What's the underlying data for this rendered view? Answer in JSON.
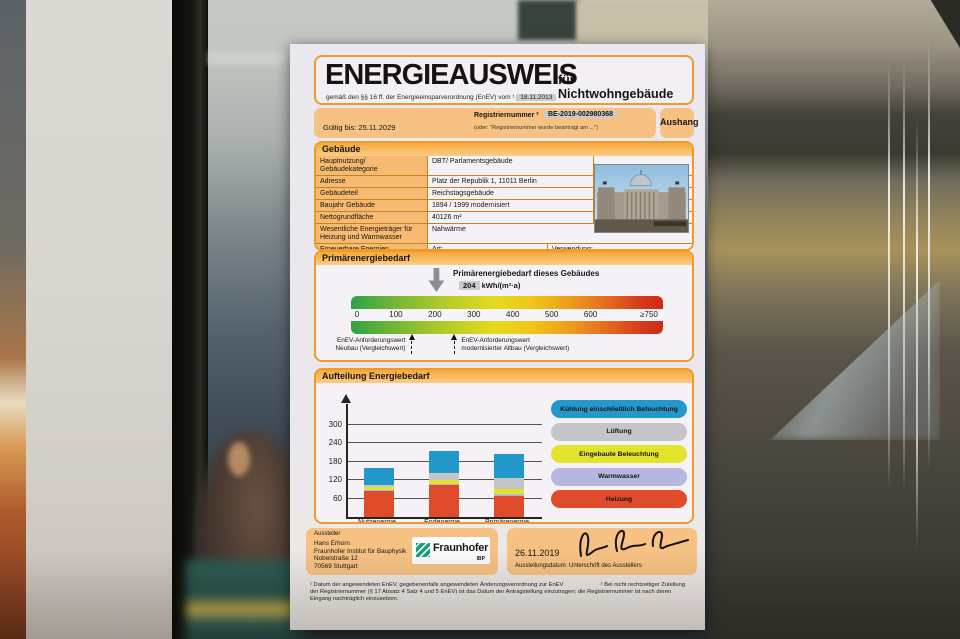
{
  "certificate": {
    "title": "ENERGIEAUSWEIS",
    "title_suffix": "für Nichtwohngebäude",
    "subtitle": "gemäß den §§ 16 ff. der Energieeinsparverordnung (EnEV) vom ¹",
    "subtitle_date": "18.11.2013",
    "valid_until": "Gültig bis: 25.11.2029",
    "registry_label": "Registriernummer ²",
    "registry_number": "BE-2019-002980368",
    "registry_note": "(oder: \"Registriernummer wurde beantragt am ...\")",
    "display_type": "Aushang"
  },
  "building": {
    "header": "Gebäude",
    "rows": [
      {
        "label": "Hauptnutzung/ Gebäudekategorie",
        "value": "DBT/ Parlamentsgebäude",
        "short": true
      },
      {
        "label": "Adresse",
        "value": "Platz der Republik 1, 11011 Berlin",
        "short": true
      },
      {
        "label": "Gebäudeteil",
        "value": "Reichstagsgebäude",
        "short": true
      },
      {
        "label": "Baujahr Gebäude",
        "value": "1894 / 1999 modernisiert",
        "short": true
      },
      {
        "label": "Nettogrundfläche",
        "value": "40126 m²",
        "short": true
      },
      {
        "label": "Wesentliche Energieträger für Heizung und Warmwasser",
        "value": "Nahwärme",
        "short": false
      },
      {
        "label": "Erneuerbare Energien",
        "value_art": "Art:",
        "value_verwendung": "Verwendung:"
      }
    ]
  },
  "primary_scale": {
    "header": "Primärenergiebedarf",
    "pointer_title": "Primärenergiebedarf dieses Gebäudes",
    "pointer_value": "204",
    "pointer_unit": "kWh/(m²·a)",
    "pointer_numeric": 204,
    "ticks": [
      {
        "label": "0",
        "value": 0
      },
      {
        "label": "100",
        "value": 100
      },
      {
        "label": "200",
        "value": 200
      },
      {
        "label": "300",
        "value": 300
      },
      {
        "label": "400",
        "value": 400
      },
      {
        "label": "500",
        "value": 500
      },
      {
        "label": "600",
        "value": 600
      },
      {
        "label": "≥750",
        "value": 750
      }
    ],
    "markers": [
      {
        "line1": "EnEV-Anforderungswert",
        "line2": "Neubau (Vergleichswert)",
        "value": 140,
        "text_side": "left"
      },
      {
        "line1": "EnEV-Anforderungswert",
        "line2": "modernisierter Altbau (Vergleichswert)",
        "value": 250,
        "text_side": "right"
      }
    ]
  },
  "chart_data": {
    "type": "bar",
    "stacked": true,
    "title": "Aufteilung Energiebedarf",
    "categories": [
      "Nutzenergie",
      "Endenergie",
      "Primärenergie"
    ],
    "series": [
      {
        "name": "Heizung",
        "color": "#e04b2b",
        "values": [
          85,
          104,
          70
        ]
      },
      {
        "name": "Warmwasser",
        "color": "#b5b7de",
        "values": [
          3,
          4,
          4
        ]
      },
      {
        "name": "Eingebaute Beleuchtung",
        "color": "#e4e32b",
        "values": [
          10,
          14,
          18
        ]
      },
      {
        "name": "Lüftung",
        "color": "#c4c5c8",
        "values": [
          6,
          20,
          34
        ]
      },
      {
        "name": "Kühlung einschließlich Befeuchtung",
        "color": "#2398cb",
        "values": [
          56,
          73,
          78
        ]
      }
    ],
    "totals": [
      160,
      215,
      204
    ],
    "yticks": [
      60,
      120,
      180,
      240,
      300
    ],
    "ylim": [
      0,
      330
    ],
    "grid": true,
    "legend_position": "right",
    "legend_order": [
      "Kühlung einschließlich Befeuchtung",
      "Lüftung",
      "Eingebaute Beleuchtung",
      "Warmwasser",
      "Heizung"
    ]
  },
  "footer": {
    "issuer_label": "Aussteller",
    "issuer_lines": [
      "Hans Erhorn",
      "Fraunhofer Institut für Bauphysik",
      "Nobelstraße 12",
      "70569 Stuttgart"
    ],
    "logo_text": "Fraunhofer",
    "logo_sub": "IBP",
    "issue_date": "26.11.2019",
    "issue_date_label": "Ausstellungsdatum",
    "signature_label": "Unterschrift des Ausstellers"
  },
  "footnotes": {
    "note1": "¹ Datum der angewendeten EnEV, gegebenenfalls angewendeten Änderungsverordnung zur EnEV",
    "note2": "² Bei nicht rechtzeitiger Zuteilung der Registriernummer (§ 17 Absatz 4 Satz 4 und 5 EnEV) ist das Datum der Antragstellung einzutragen; die Registriernummer ist nach deren Eingang nachträglich einzusetzen."
  },
  "colors": {
    "accent_orange": "#ee9b27",
    "band_orange": "#f6c183",
    "label_cell_orange": "#f6ba72",
    "pointer_gray": "#8b8e92"
  }
}
